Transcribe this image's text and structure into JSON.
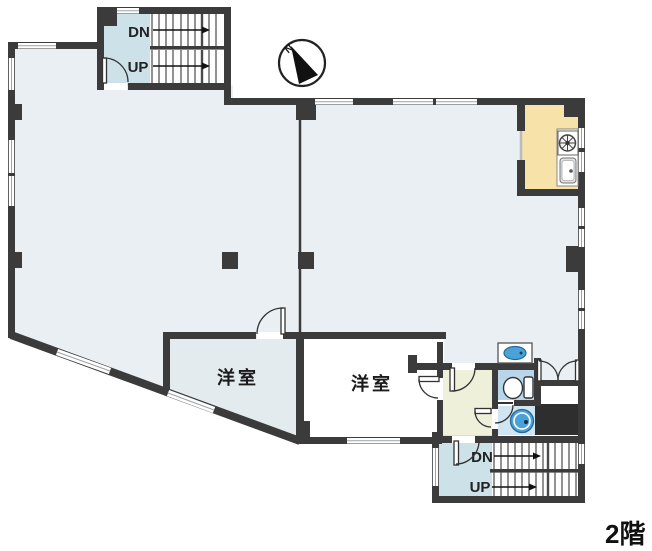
{
  "floor_label": "2階",
  "compass": {
    "label": "N"
  },
  "rooms": [
    {
      "id": "youshitsu-left",
      "label": "洋室"
    },
    {
      "id": "youshitsu-right",
      "label": "洋室"
    }
  ],
  "stairs": {
    "upper": {
      "down": "DN",
      "up": "UP"
    },
    "lower": {
      "down": "DN",
      "up": "UP"
    }
  },
  "fixtures": {
    "kitchen": [
      "stove-icon",
      "kitchen-sink-icon"
    ],
    "sanitary": [
      "wash-basin-icon",
      "toilet-icon",
      "laundry-basin-icon"
    ],
    "navigation": [
      "compass-north-icon"
    ]
  },
  "colors": {
    "wall": "#3b3b3b",
    "floor_main": "#e9eff2",
    "floor_room_left": "#e3ebef",
    "floor_room_right": "#ffffff",
    "floor_landing": "#cde1e9",
    "floor_kitchen": "#f7e2a9",
    "floor_hall": "#eef0da",
    "floor_toilet": "#b8d5ea",
    "floor_washroom": "#d1e4f1",
    "duct": "#2e2e2e",
    "fixture": "#4ba2d6",
    "fixture_dark": "#26689a"
  }
}
